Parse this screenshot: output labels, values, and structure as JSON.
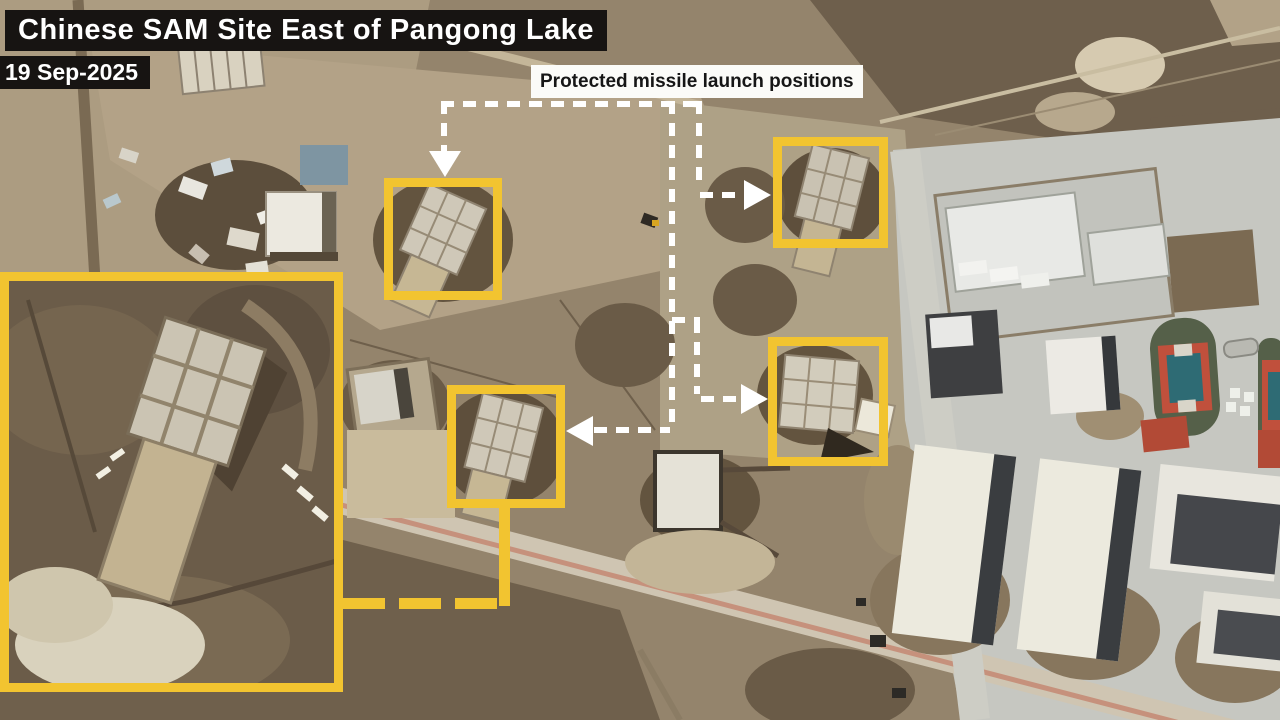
{
  "title_bar": {
    "text": "Chinese SAM Site East of Pangong Lake"
  },
  "date_badge": {
    "text": "19 Sep-2025"
  },
  "callout": {
    "text": "Protected missile launch positions"
  },
  "highlight_boxes": [
    {
      "name": "launch-position-1"
    },
    {
      "name": "launch-position-2"
    },
    {
      "name": "launch-position-3"
    },
    {
      "name": "launch-position-4"
    }
  ],
  "inset": {
    "name": "zoom-inset-of-launch-position"
  },
  "icons": {
    "arrow_down": "down-arrow-icon",
    "arrow_right": "right-arrow-icon",
    "arrow_left": "left-arrow-icon"
  },
  "colors": {
    "highlight_yellow": "#f2c430",
    "connector_white": "#ffffff",
    "title_bg": "#171412",
    "title_fg": "#ffffff",
    "callout_bg": "#fbfbf8",
    "callout_fg": "#161616"
  }
}
